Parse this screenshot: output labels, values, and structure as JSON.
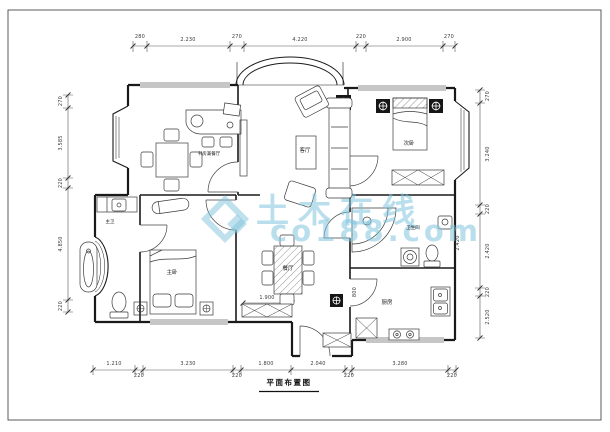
{
  "sheet": {
    "title": "平面布置图"
  },
  "watermark": {
    "brand": "土木在线",
    "site": "co188.com"
  },
  "rooms": {
    "study_dining": "书房兼餐厅",
    "living": "客厅",
    "bedroom2": "次卧",
    "master_bedroom": "主卧",
    "master_bath": "主卫",
    "dining": "餐厅",
    "kitchen": "厨房",
    "bath2": "卫生间"
  },
  "dims": {
    "top": [
      "280",
      "2.230",
      "270",
      "4.220",
      "220",
      "2.900",
      "270"
    ],
    "bottom": [
      "1.210",
      "220",
      "3.230",
      "220",
      "1.800",
      "2.040",
      "220",
      "3.280",
      "220"
    ],
    "left": [
      "270",
      "3.585",
      "220",
      "4.850",
      "220"
    ],
    "right": [
      "270",
      "3.240",
      "220",
      "2.420",
      "220",
      "2.520"
    ],
    "inner": [
      "1.900",
      "800",
      "2.420"
    ]
  }
}
